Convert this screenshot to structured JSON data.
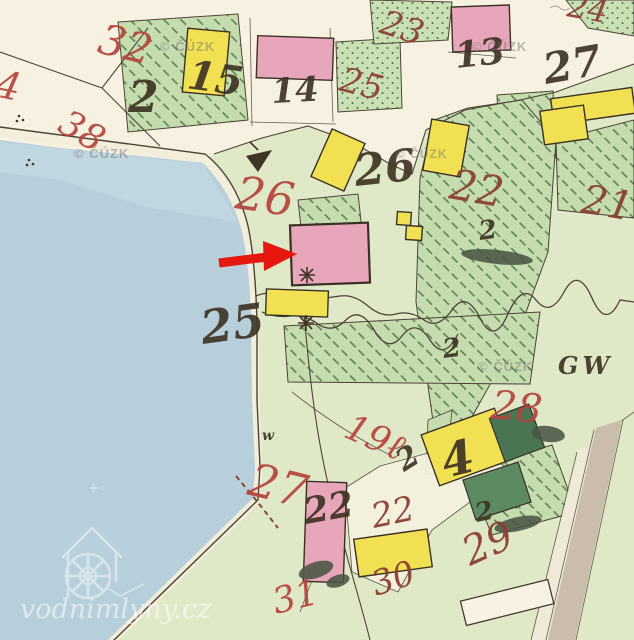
{
  "map": {
    "type": "historical-cadastral-map-viewer",
    "description": "old hand-coloured cadastre sheet with pond, parcels and mill marked by red arrow",
    "watermark": "© ČÚZK",
    "site_watermark": "vodnimlyny.cz"
  },
  "colors": {
    "paper": "#f6f1e0",
    "land": "#dfe9c8",
    "land-edge": "#4d4336",
    "water": "#b6cfdb",
    "water-light": "#c9dde5",
    "shore-glow": "#f2eedb",
    "hatch-fill": "#c5dcae",
    "hatch-line": "#567d4f",
    "dots-fill": "#c9e0b4",
    "dot-ink": "#4e6b45",
    "pink": "#e8a6ba",
    "yellow": "#f1e052",
    "green-bldg": "#4a7553",
    "green-bldg2": "#5c8a63",
    "outline": "#3a3126",
    "road": "#cbbdab",
    "road-light": "#efe9d8",
    "white-bldg": "#f7f2e2",
    "number-red": "#b5443c",
    "number-darkred": "#8d4034",
    "ink-black": "#3f3425",
    "blob": "#4a5544",
    "arrow-red": "#e5170e",
    "watermark-gray": "#6f6f6f",
    "dash-red": "#8a4238"
  },
  "labels": [
    {
      "t": "4",
      "kind": "parcel-number-red"
    },
    {
      "t": "32",
      "kind": "parcel-number-red"
    },
    {
      "t": "38",
      "kind": "parcel-number-red"
    },
    {
      "t": "23",
      "kind": "parcel-number-darkred"
    },
    {
      "t": "25",
      "kind": "parcel-number-darkred"
    },
    {
      "t": "26",
      "kind": "parcel-number-red"
    },
    {
      "t": "22",
      "kind": "parcel-number-darkred"
    },
    {
      "t": "21",
      "kind": "parcel-number-darkred"
    },
    {
      "t": "24",
      "kind": "parcel-number-darkred"
    },
    {
      "t": "19ℓ",
      "kind": "parcel-number-red"
    },
    {
      "t": "28",
      "kind": "parcel-number-red"
    },
    {
      "t": "27",
      "kind": "parcel-number-red"
    },
    {
      "t": "31",
      "kind": "parcel-number-red"
    },
    {
      "t": "30",
      "kind": "parcel-number-darkred"
    },
    {
      "t": "29",
      "kind": "parcel-number-darkred"
    },
    {
      "t": "22",
      "kind": "parcel-number-darkred"
    },
    {
      "t": "2",
      "kind": "house-number-black"
    },
    {
      "t": "15",
      "kind": "house-number-black"
    },
    {
      "t": "14",
      "kind": "house-number-black"
    },
    {
      "t": "13",
      "kind": "house-number-black"
    },
    {
      "t": "27",
      "kind": "house-number-black"
    },
    {
      "t": "26",
      "kind": "house-number-black"
    },
    {
      "t": "25",
      "kind": "house-number-black"
    },
    {
      "t": "2",
      "kind": "house-number-black"
    },
    {
      "t": "4",
      "kind": "house-number-black"
    },
    {
      "t": "22",
      "kind": "house-number-black"
    },
    {
      "t": "GW",
      "kind": "map-inscription"
    },
    {
      "t": "w",
      "kind": "map-inscription"
    },
    {
      "t": "2",
      "kind": "script-mark"
    },
    {
      "t": "2",
      "kind": "script-mark"
    },
    {
      "t": "2",
      "kind": "script-mark"
    },
    {
      "t": "© ČÚZK",
      "kind": "watermark"
    },
    {
      "t": "© ČÚZK",
      "kind": "watermark"
    },
    {
      "t": "© ČÚZK",
      "kind": "watermark"
    },
    {
      "t": "© ČÚZK",
      "kind": "watermark"
    },
    {
      "t": "© ČÚZK",
      "kind": "watermark"
    },
    {
      "t": "vodnimlyny.cz",
      "kind": "site-watermark"
    }
  ]
}
